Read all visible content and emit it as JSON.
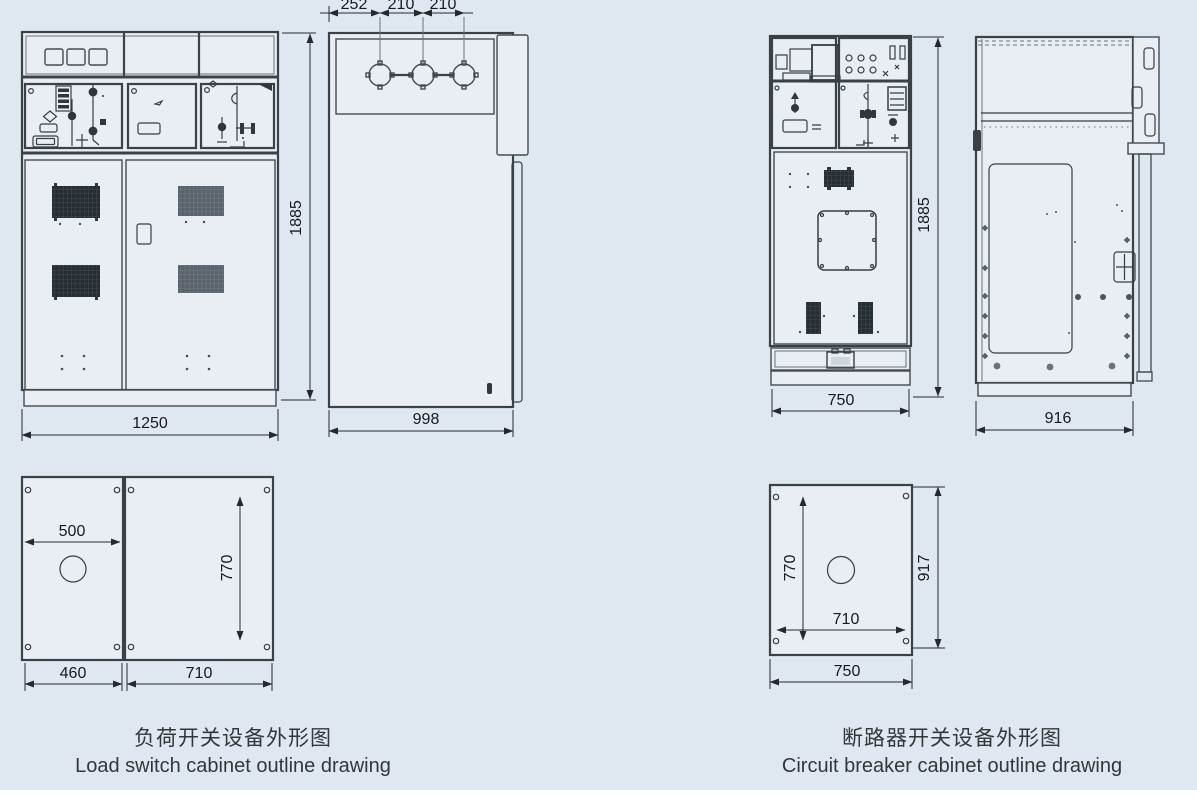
{
  "page": {
    "background_color": "#dfe8f0",
    "line_color": "#3a4147",
    "paper_strip_color": "#ffffff"
  },
  "load_switch": {
    "caption_zh": "负荷开关设备外形图",
    "caption_en": "Load switch cabinet outline drawing",
    "front_view": {
      "width_label": "1250",
      "height_label": "1885"
    },
    "side_view": {
      "depth_label": "998",
      "spacing_labels": [
        "252",
        "210",
        "210"
      ]
    },
    "plan_view": {
      "width_label": "500",
      "inner_height_label": "770",
      "left_base_label": "460",
      "right_base_label": "710"
    }
  },
  "circuit_breaker": {
    "caption_zh": "断路器开关设备外形图",
    "caption_en": "Circuit breaker cabinet outline drawing",
    "front_view": {
      "width_label": "750",
      "height_label": "1885"
    },
    "side_view": {
      "depth_label": "916"
    },
    "plan_view": {
      "inner_height_label": "770",
      "inner_width_label": "710",
      "overall_height_label": "917",
      "base_width_label": "750"
    }
  }
}
